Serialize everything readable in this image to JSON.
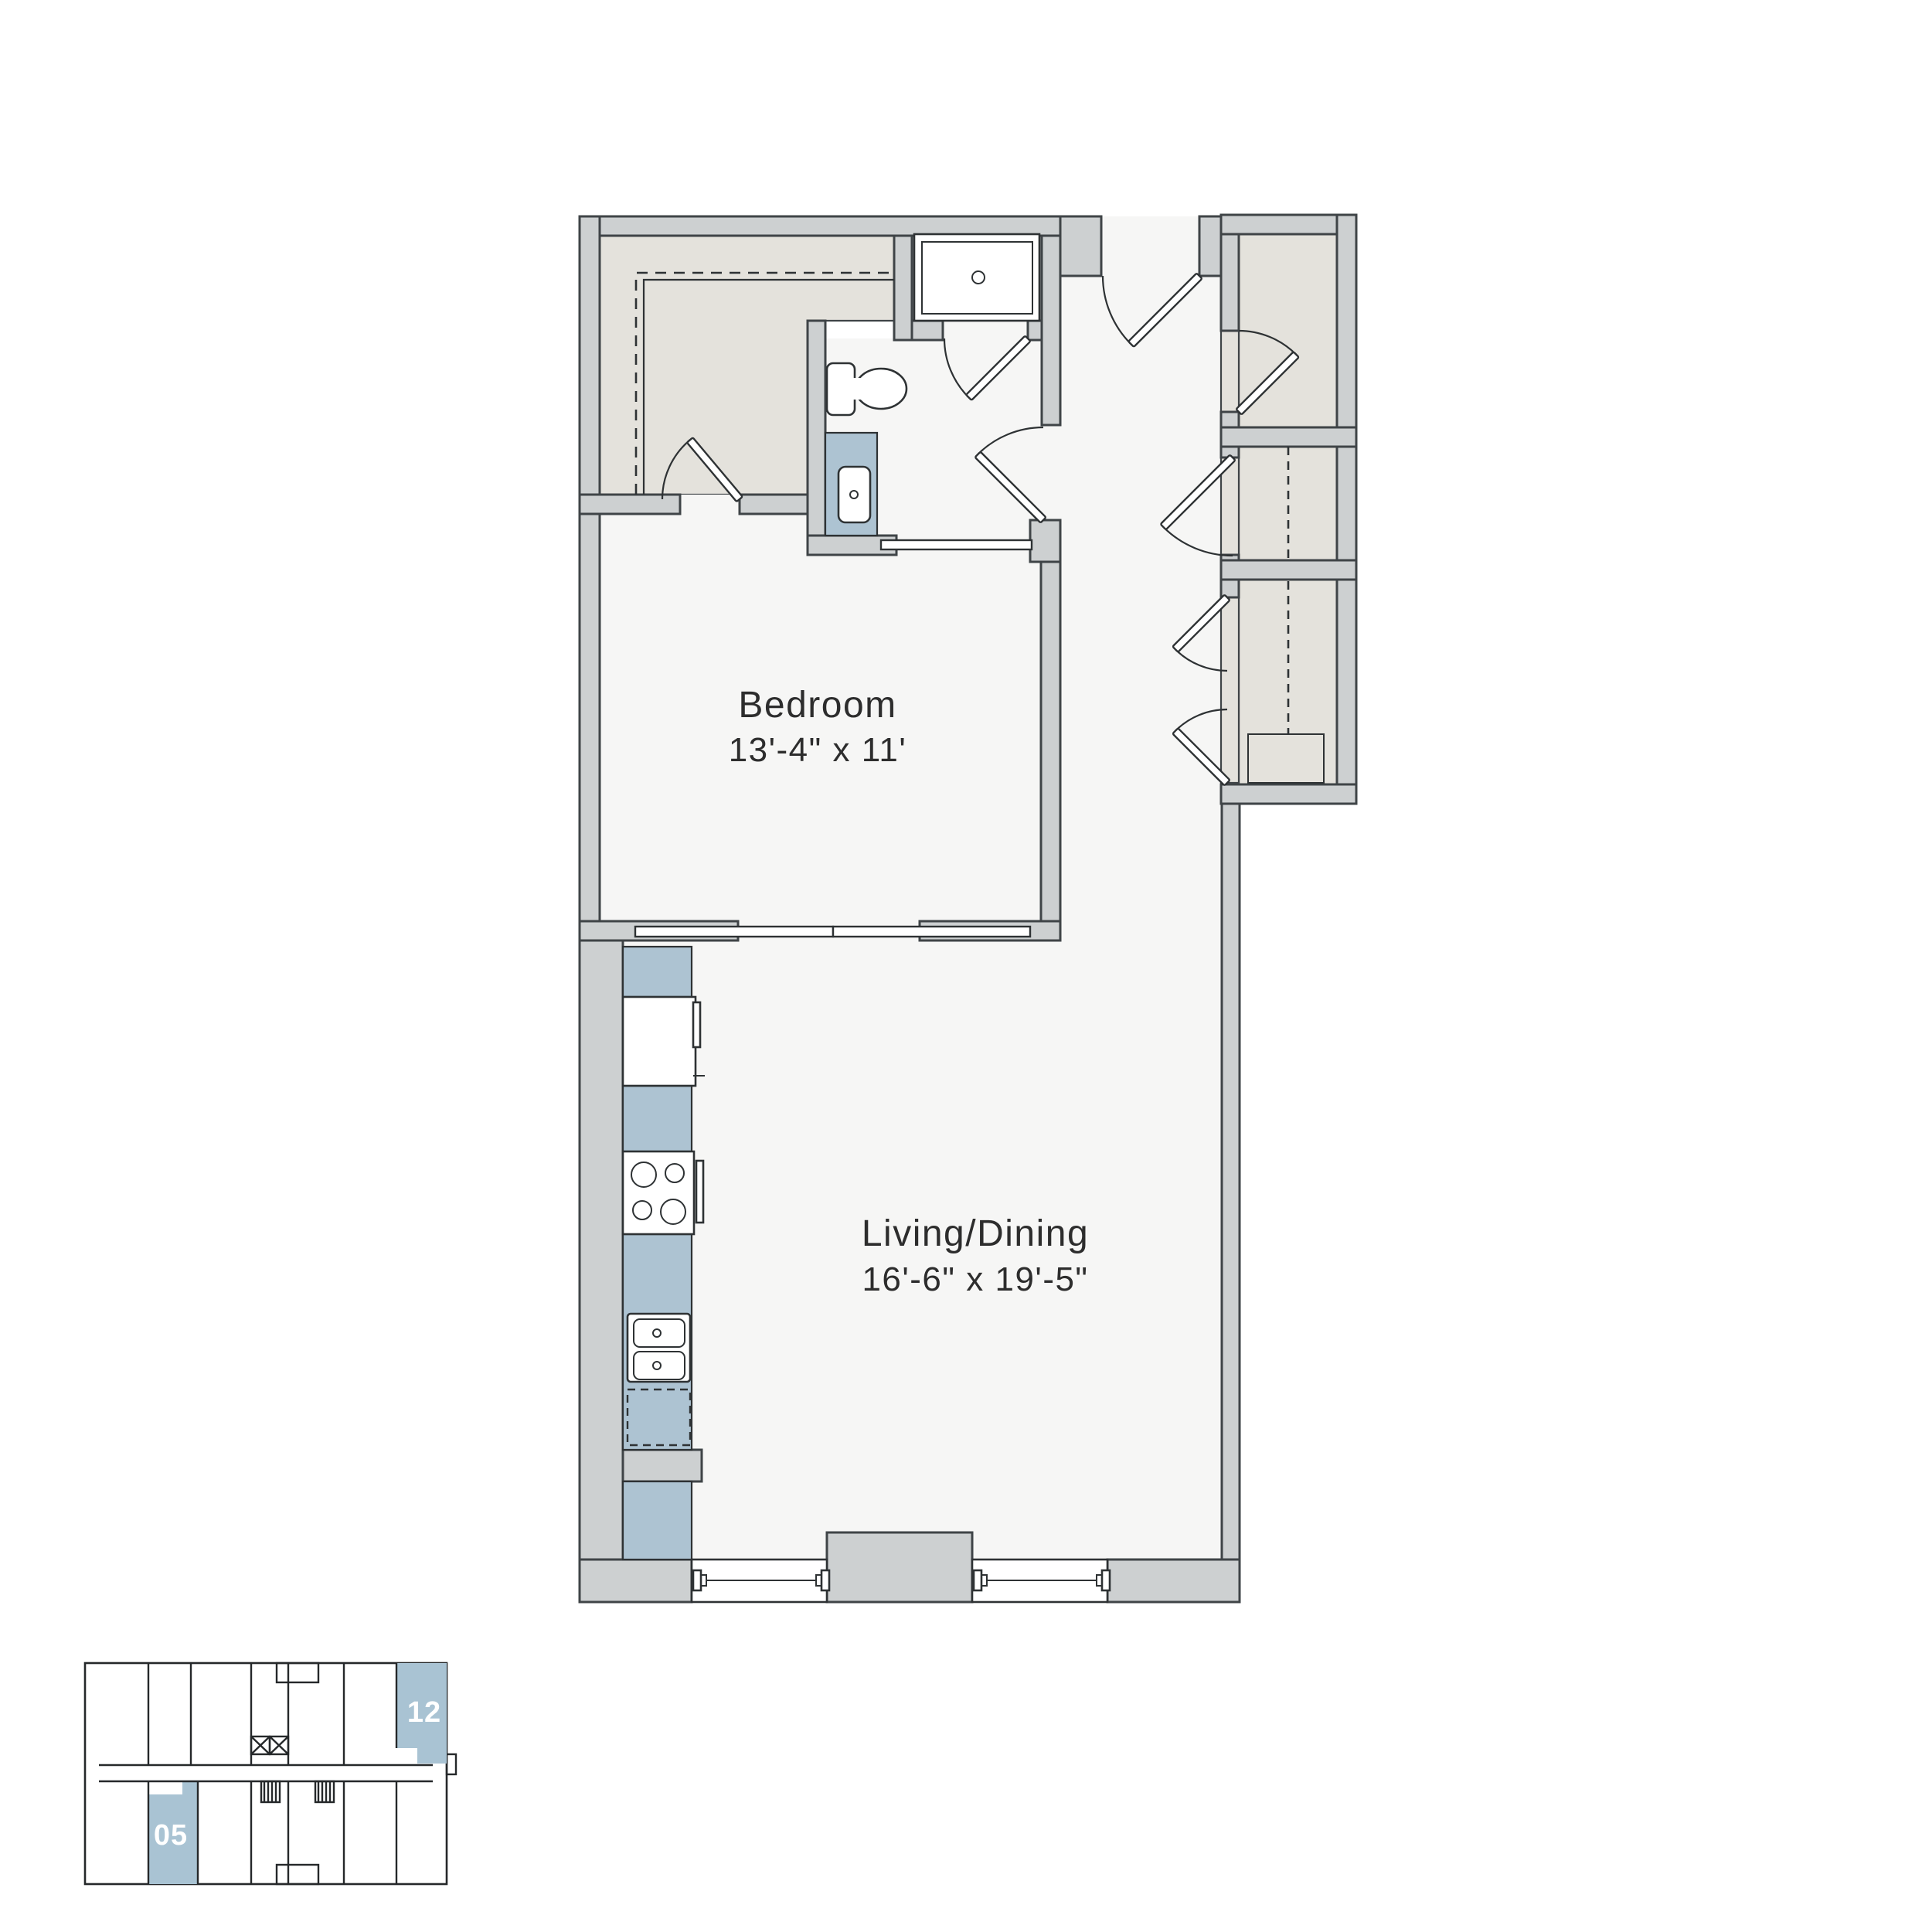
{
  "palette": {
    "wall": "#cdd0d1",
    "wall_outline": "#3f4447",
    "floor": "#f6f6f5",
    "closet_floor": "#e4e2dc",
    "counter_blue": "#adc3d2",
    "line_dark": "#2e3234",
    "text": "#2d2d2d",
    "keyplan_line": "#25282a",
    "highlight": "#a9c3d3"
  },
  "rooms": {
    "bedroom": {
      "name": "Bedroom",
      "dims": "13'-4\" x 11'"
    },
    "living": {
      "name": "Living/Dining",
      "dims": "16'-6\" x 19'-5\""
    }
  },
  "keyplan": {
    "units": [
      {
        "label": "12"
      },
      {
        "label": "05"
      }
    ]
  },
  "fixtures": [
    "shower",
    "toilet",
    "vanity-sink",
    "refrigerator",
    "range",
    "kitchen-sink",
    "dishwasher",
    "washer-dryer",
    "window",
    "window",
    "entry-door",
    "pocket-door",
    "sliding-doors",
    "closet-doors"
  ]
}
